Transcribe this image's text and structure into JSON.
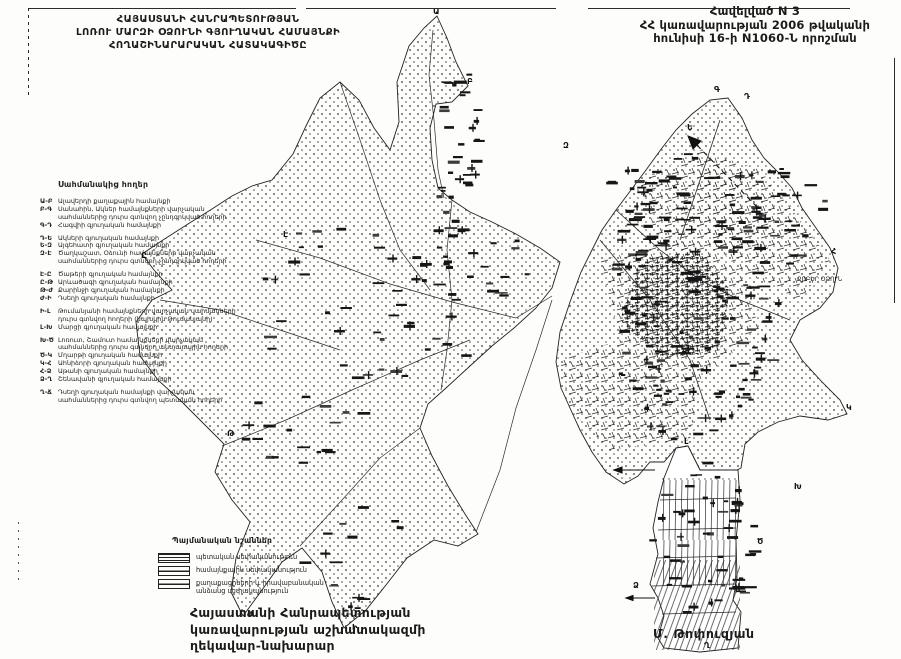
{
  "header_left": {
    "line1": "ՀԱՅԱՍՏԱՆԻ ՀԱՆՐԱՊԵՏՈՒԹՅԱՆ",
    "line2": "ԼՈՌՈՒ ՄԱՐԶԻ ՕՁՈՒՆԻ ԳՅՈՒՂԱԿԱՆ ՀԱՄԱՅՆՔԻ",
    "line3": "ՀՈՂԱՇԻՆԱՐԱՐԱԿԱՆ ՀԱՏԱԿԱԳԻԾԸ"
  },
  "header_right": {
    "line1": "Հավելված N 3",
    "line2": "ՀՀ կառավարության 2006 թվականի",
    "line3": "հունիսի 16-ի N1060-Ն որոշման"
  },
  "legend": {
    "title": "Սահմանակից հողեր",
    "items": [
      {
        "code": "Ա-Բ",
        "text": "Ալավերդի քաղաքային համայնքի",
        "cont": false,
        "gap": false
      },
      {
        "code": "Բ-Գ",
        "text": "Սանահին, Ակներ համայնքների վարչական",
        "cont": false,
        "gap": false
      },
      {
        "code": "",
        "text": "սահմաններից դուրս գտնվող չընդգրկված հողերի",
        "cont": true,
        "gap": false
      },
      {
        "code": "Գ-Դ",
        "text": "Հագվիի գյուղական համայնքի",
        "cont": false,
        "gap": false
      },
      {
        "code": "Դ-Ե",
        "text": "Ակների գյուղական համայնքի",
        "cont": false,
        "gap": true
      },
      {
        "code": "Ե-Զ",
        "text": "Այգեհատի գյուղական համայնքի",
        "cont": false,
        "gap": false
      },
      {
        "code": "Զ-Է",
        "text": "Ծաղկաշատ, Օձունի համայնքների վարչական",
        "cont": false,
        "gap": false
      },
      {
        "code": "",
        "text": "սահմաններից դուրս գտնվող չընդգրկված հողերի",
        "cont": true,
        "gap": false
      },
      {
        "code": "Է-Ը",
        "text": "Ծաթերի գյուղական համայնքի",
        "cont": false,
        "gap": true
      },
      {
        "code": "Ը-Թ",
        "text": "Արևածագի գյուղական համայնքի",
        "cont": false,
        "gap": false
      },
      {
        "code": "Թ-Ժ",
        "text": "Քարինջի գյուղական համայնքի",
        "cont": false,
        "gap": false
      },
      {
        "code": "Ժ-Ի",
        "text": "Դսեղի գյուղական համայնքի",
        "cont": false,
        "gap": false
      },
      {
        "code": "Ի-Լ",
        "text": "Թումանյանի համայնքների վարչական սահմանների",
        "cont": false,
        "gap": true
      },
      {
        "code": "",
        "text": "դուրս գտնվող հողերի (նախկին Թումանյանի)",
        "cont": true,
        "gap": false
      },
      {
        "code": "Լ-Խ",
        "text": "Մարցի գյուղական համայնքի",
        "cont": false,
        "gap": false
      },
      {
        "code": "Խ-Ծ",
        "text": "Լոռուտ, Շամուտ համայնքների վարչական",
        "cont": false,
        "gap": true
      },
      {
        "code": "",
        "text": "սահմաններից դուրս գտնվող անտառային հողերի",
        "cont": true,
        "gap": false
      },
      {
        "code": "Ծ-Կ",
        "text": "Մղարթի գյուղական համայնքի",
        "cont": false,
        "gap": false
      },
      {
        "code": "Կ-Հ",
        "text": "Ահնիձորի գյուղական համայնքի",
        "cont": false,
        "gap": false
      },
      {
        "code": "Հ-Ձ",
        "text": "Աթանի գյուղական համայնքի",
        "cont": false,
        "gap": false
      },
      {
        "code": "Ձ-Ղ",
        "text": "Շենավանի գյուղական համայնքի",
        "cont": false,
        "gap": false
      },
      {
        "code": "Ղ-Ճ",
        "text": "Դսեղի գյուղական համայնքի վարչական",
        "cont": false,
        "gap": true
      },
      {
        "code": "",
        "text": "սահմաններից դուրս գտնվող պետական հողերի",
        "cont": true,
        "gap": false
      }
    ]
  },
  "symbols_box": {
    "title": "Պայմանական նշաններ",
    "items": [
      {
        "label": "պետական սեփականություն",
        "swatch": "hatch"
      },
      {
        "label": "համայնքային սեփականություն",
        "swatch": "hline"
      },
      {
        "label": "քաղաքացիների և իրավաբանական\nանձանց սեփականություն",
        "swatch": "hline"
      }
    ]
  },
  "signature": {
    "line1": "Հայաստանի Հանրապետության",
    "line2": "կառավարության աշխատակազմի",
    "line3": "ղեկավար-նախարար",
    "name": "Մ. Թոփուզյան"
  },
  "map": {
    "place_label": {
      "text": "ՔՈԲԵՐ ՕՁՈՒՆ",
      "x": 797,
      "y": 281
    },
    "boundary_letters": [
      {
        "ch": "Ա",
        "x": 433,
        "y": 14
      },
      {
        "ch": "Բ",
        "x": 467,
        "y": 84
      },
      {
        "ch": "Գ",
        "x": 714,
        "y": 92
      },
      {
        "ch": "Դ",
        "x": 744,
        "y": 99
      },
      {
        "ch": "Ե",
        "x": 687,
        "y": 130
      },
      {
        "ch": "Զ",
        "x": 563,
        "y": 148
      },
      {
        "ch": "Է",
        "x": 283,
        "y": 237
      },
      {
        "ch": "Ը",
        "x": 141,
        "y": 258
      },
      {
        "ch": "Թ",
        "x": 227,
        "y": 436
      },
      {
        "ch": "Ժ",
        "x": 247,
        "y": 617
      },
      {
        "ch": "Ի",
        "x": 352,
        "y": 630
      },
      {
        "ch": "Լ",
        "x": 684,
        "y": 444
      },
      {
        "ch": "Խ",
        "x": 794,
        "y": 489
      },
      {
        "ch": "Ծ",
        "x": 757,
        "y": 544
      },
      {
        "ch": "Կ",
        "x": 846,
        "y": 410
      },
      {
        "ch": "Հ",
        "x": 831,
        "y": 254
      },
      {
        "ch": "Ձ",
        "x": 633,
        "y": 588
      },
      {
        "ch": "Ղ",
        "x": 704,
        "y": 648
      }
    ]
  }
}
